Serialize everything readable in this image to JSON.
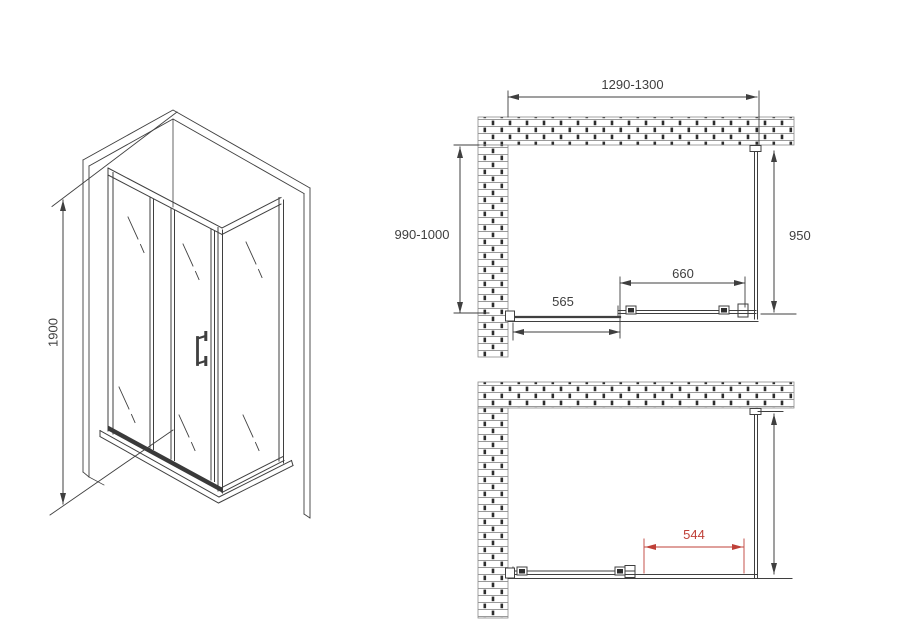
{
  "meta": {
    "description": "Shower enclosure installation technical drawing with isometric view and two plan views"
  },
  "colors": {
    "line": "#3f3f3f",
    "dim_red": "#bf4038",
    "background": "#ffffff"
  },
  "iso_view": {
    "height": "1900"
  },
  "top_plan": {
    "overall_width": "1290-1300",
    "depth": "990-1000",
    "side_panel": "950",
    "door_width": "660",
    "fixed_panel_width": "565"
  },
  "bottom_plan": {
    "opening_width": "544"
  }
}
